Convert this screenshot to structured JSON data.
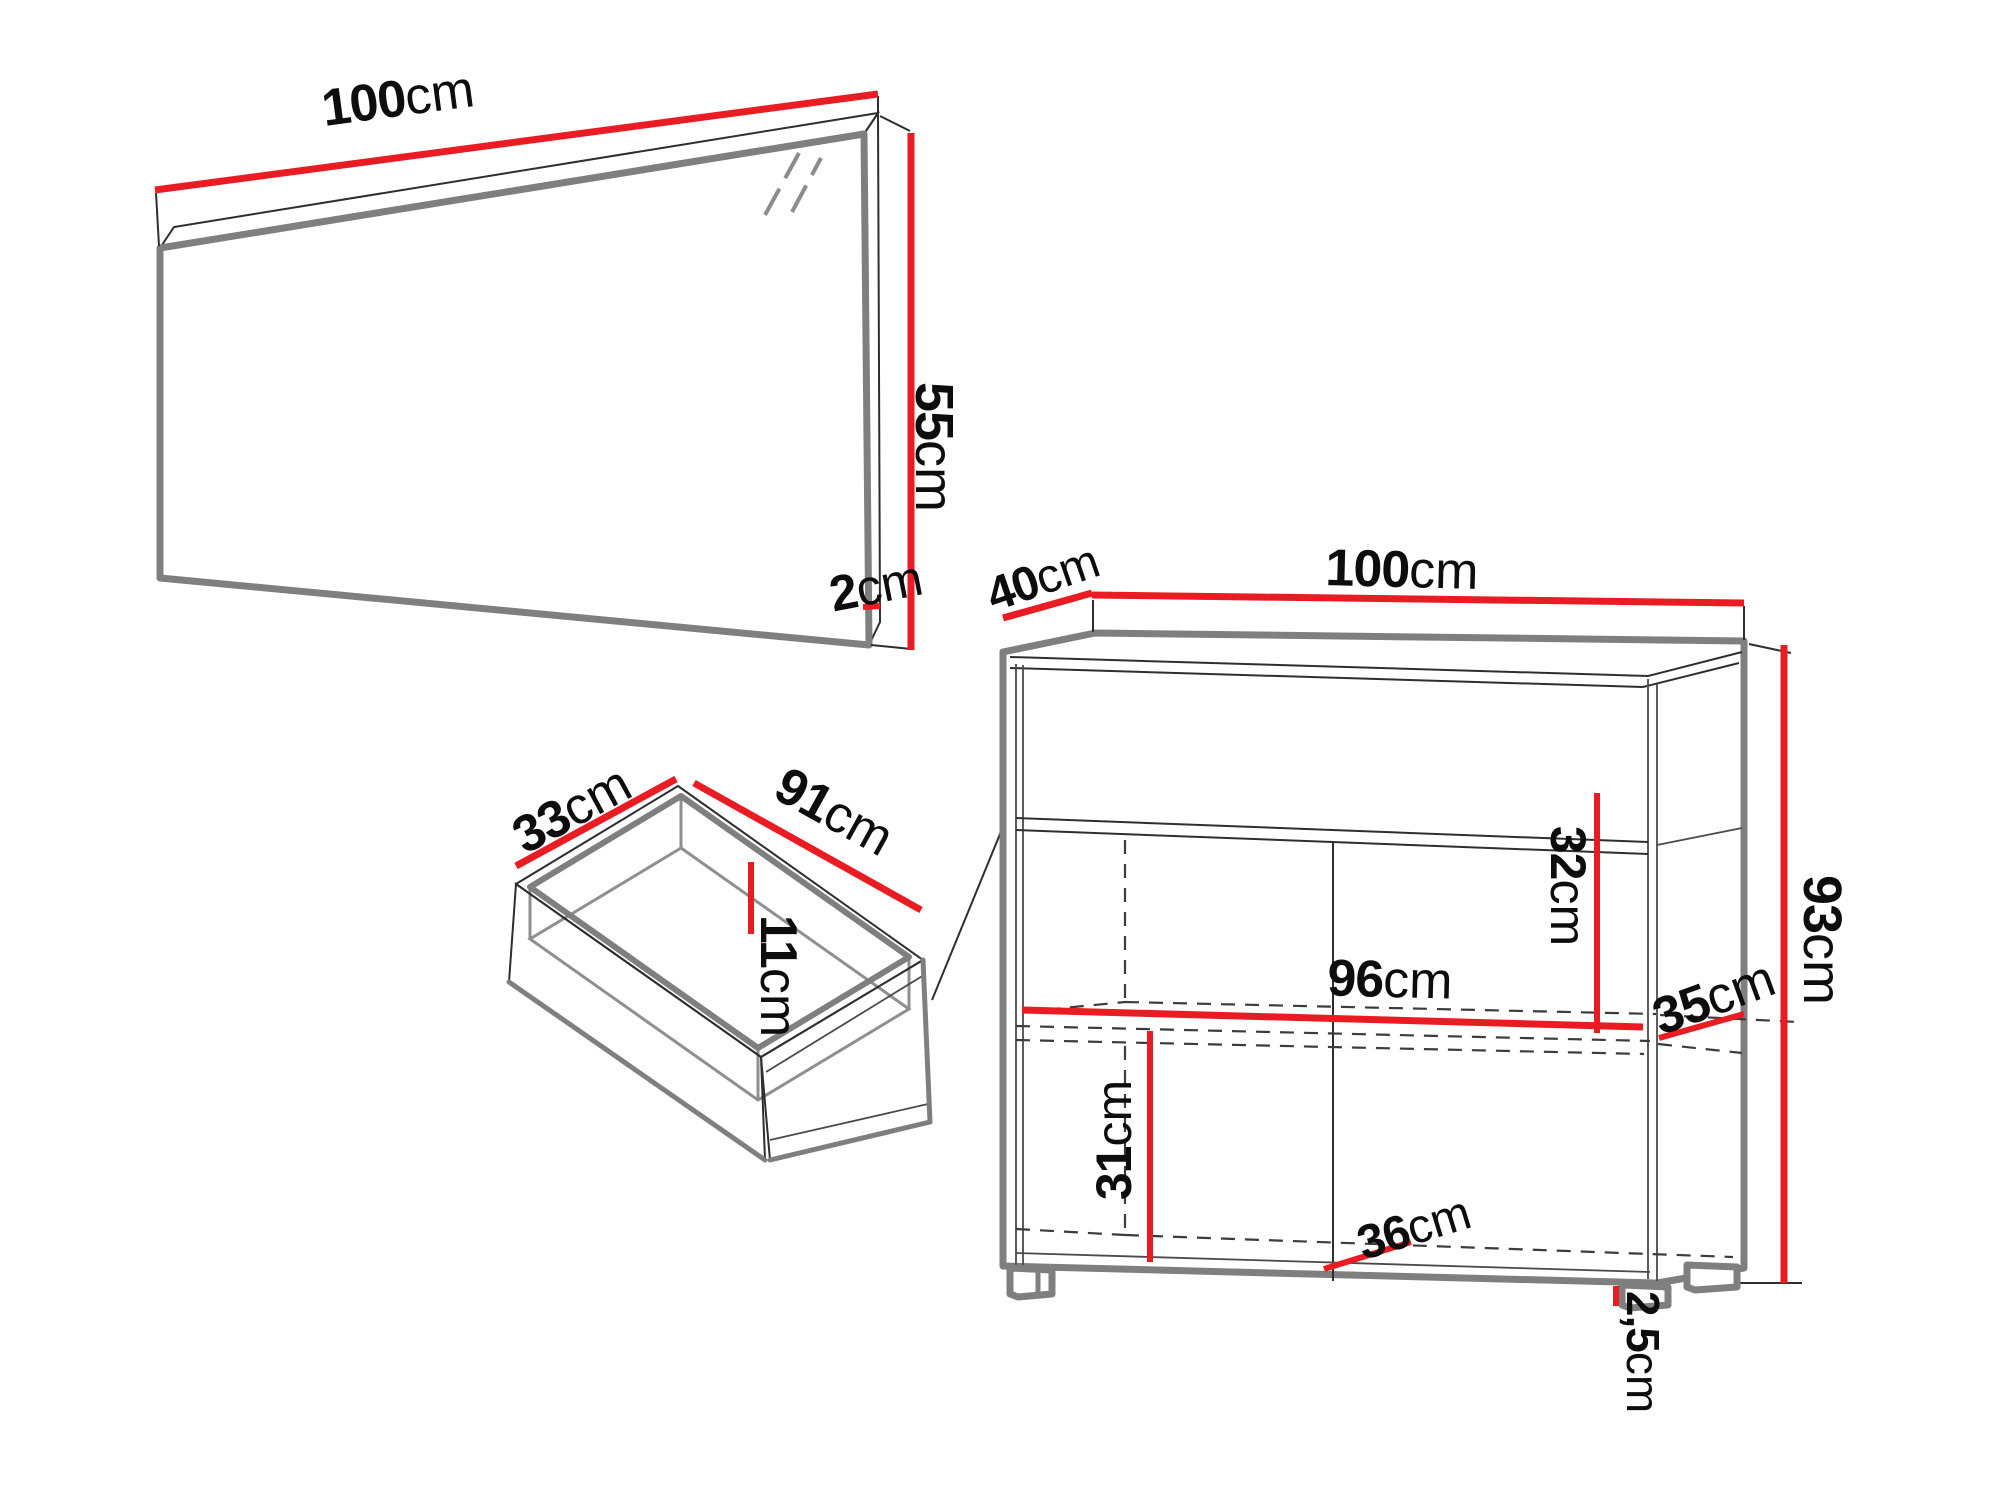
{
  "meta": {
    "title": "Furniture dimensions diagram"
  },
  "colors": {
    "dimension_red": "#e91c23",
    "outline_gray": "#7f7f7f",
    "line_dark": "#2e2e2e",
    "label_black": "#0d0d0d",
    "background": "#ffffff"
  },
  "mirror": {
    "width": {
      "value": "100",
      "unit": "cm"
    },
    "height": {
      "value": "55",
      "unit": "cm"
    },
    "depth": {
      "value": "2",
      "unit": "cm"
    }
  },
  "drawer": {
    "depth": {
      "value": "33",
      "unit": "cm"
    },
    "width": {
      "value": "91",
      "unit": "cm"
    },
    "height": {
      "value": "11",
      "unit": "cm"
    }
  },
  "cabinet": {
    "depth": {
      "value": "40",
      "unit": "cm"
    },
    "width": {
      "value": "100",
      "unit": "cm"
    },
    "height": {
      "value": "93",
      "unit": "cm"
    },
    "interior_width": {
      "value": "96",
      "unit": "cm"
    },
    "upper_compartment_height": {
      "value": "32",
      "unit": "cm"
    },
    "lower_compartment_height": {
      "value": "31",
      "unit": "cm"
    },
    "shelf_depth": {
      "value": "35",
      "unit": "cm"
    },
    "interior_depth_bottom": {
      "value": "36",
      "unit": "cm"
    },
    "feet_height": {
      "value": "2,5",
      "unit": "cm"
    }
  }
}
